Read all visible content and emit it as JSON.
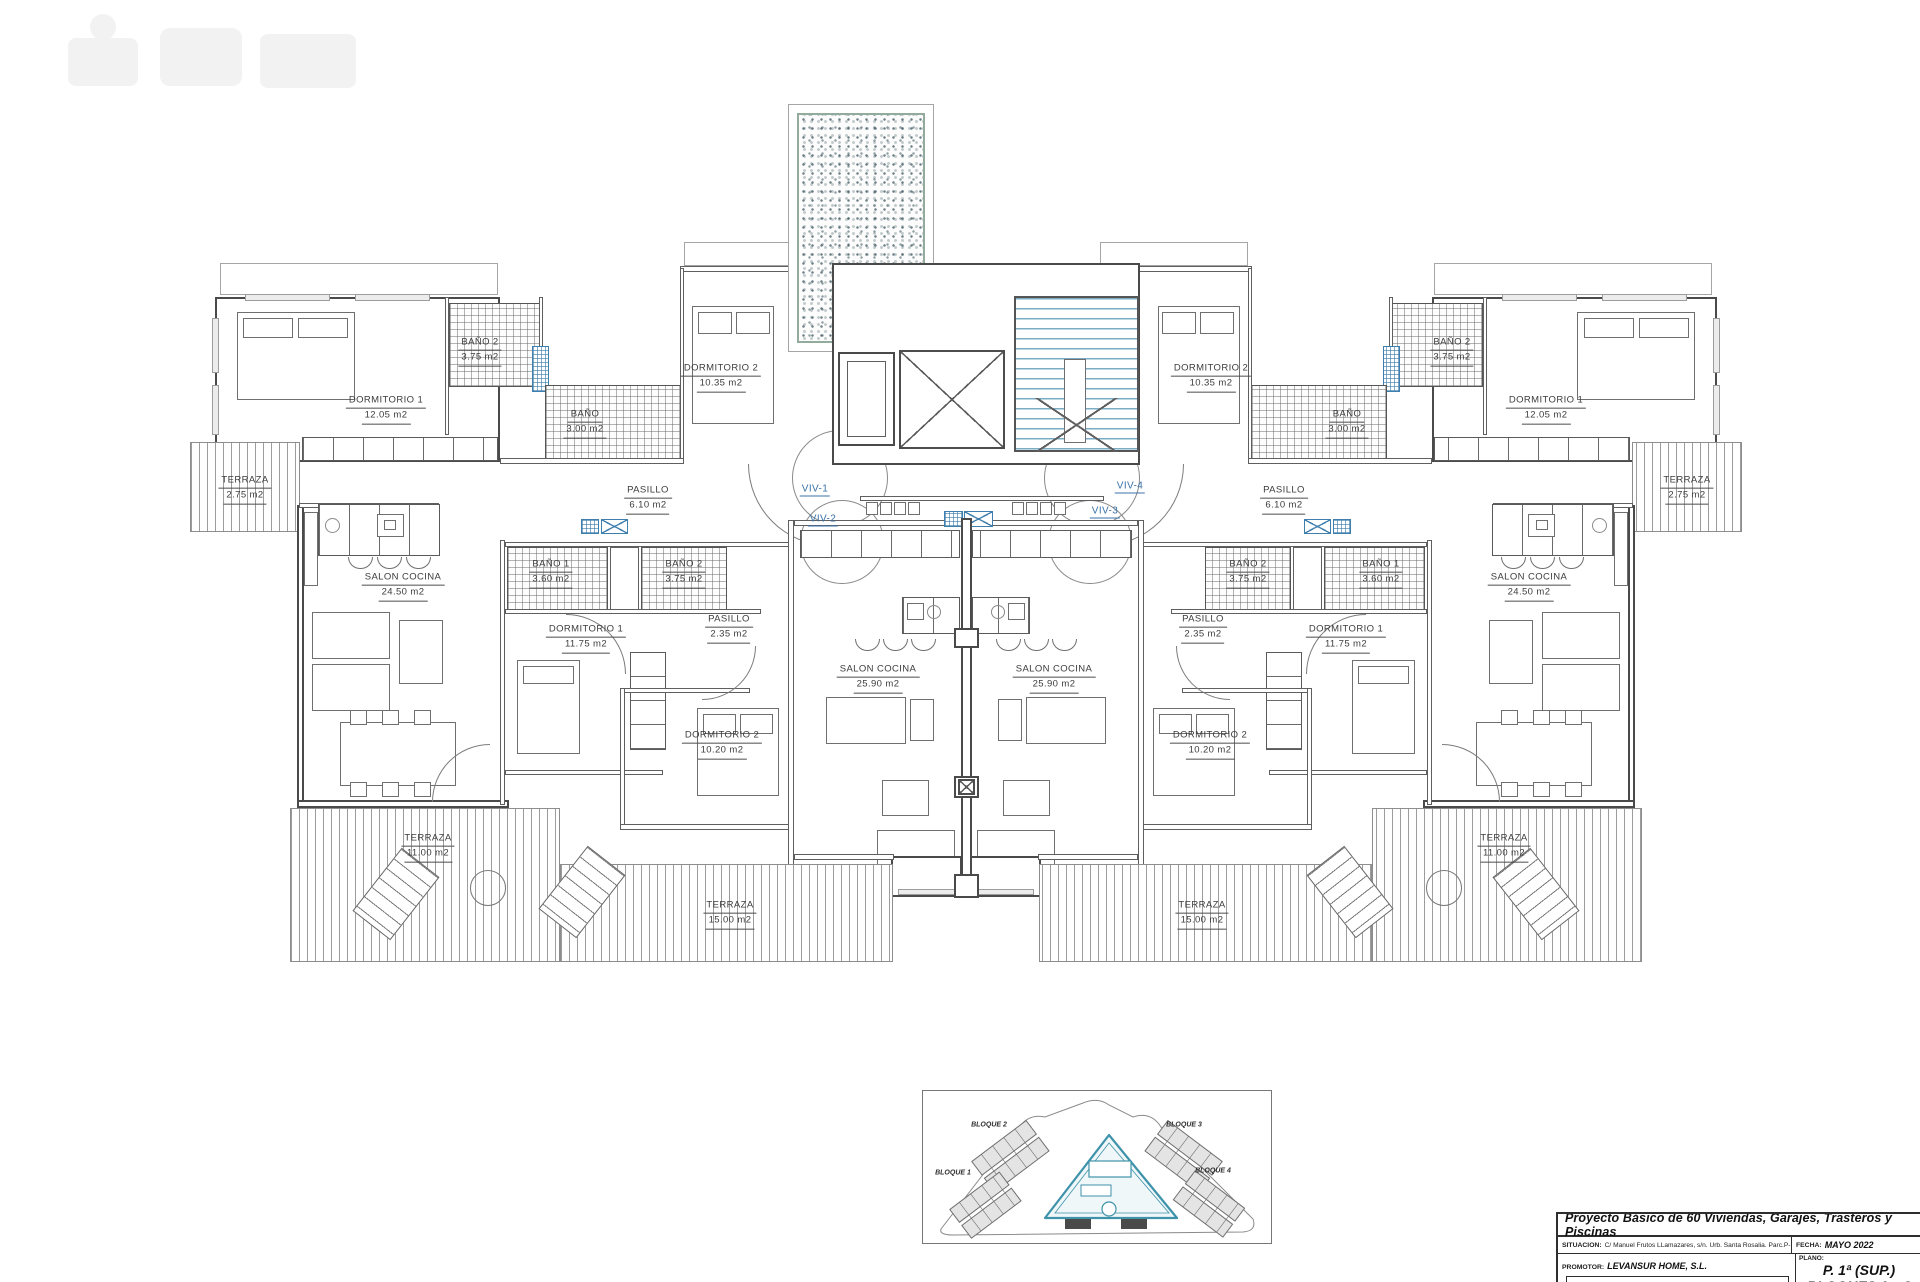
{
  "rooms": {
    "dorm1_top": {
      "name": "DORMITORIO 1",
      "area": "12.05 m2"
    },
    "bano2_top": {
      "name": "BAÑO 2",
      "area": "3.75 m2"
    },
    "bano_top": {
      "name": "BAÑO",
      "area": "3.00 m2"
    },
    "dorm2_top": {
      "name": "DORMITORIO 2",
      "area": "10.35 m2"
    },
    "terraza_top": {
      "name": "TERRAZA",
      "area": "2.75 m2"
    },
    "pasillo_top": {
      "name": "PASILLO",
      "area": "6.10 m2"
    },
    "salon_cocina_24": {
      "name": "SALON COCINA",
      "area": "24.50 m2"
    },
    "bano1_mid": {
      "name": "BAÑO 1",
      "area": "3.60 m2"
    },
    "bano2_mid": {
      "name": "BAÑO 2",
      "area": "3.75 m2"
    },
    "dorm1_mid": {
      "name": "DORMITORIO 1",
      "area": "11.75 m2"
    },
    "pasillo_mid": {
      "name": "PASILLO",
      "area": "2.35 m2"
    },
    "salon_cocina_25": {
      "name": "SALON COCINA",
      "area": "25.90 m2"
    },
    "dorm2_mid": {
      "name": "DORMITORIO 2",
      "area": "10.20 m2"
    },
    "terraza_11": {
      "name": "TERRAZA",
      "area": "11.00 m2"
    },
    "terraza_15": {
      "name": "TERRAZA",
      "area": "15.00 m2"
    }
  },
  "viv_labels": {
    "v1": "VIV-1",
    "v2": "VIV-2",
    "v3": "VIV-3",
    "v4": "VIV-4"
  },
  "site_plan": {
    "b1": "BLOQUE 1",
    "b2": "BLOQUE 2",
    "b3": "BLOQUE 3",
    "b4": "BLOQUE 4"
  },
  "title_block": {
    "project_title": "Proyecto Básico de 60 Viviendas, Garajes, Trasteros y Piscinas",
    "situacion_label": "SITUACION:",
    "situacion_value": "C/ Manuel Frutos LLamazares, s/n. Urb. Santa Rosalia. Parc.P-10",
    "promotor_label": "PROMOTOR:",
    "promotor_value": "LEVANSUR HOME, S.L.",
    "fecha_label": "FECHA:",
    "fecha_value": "MAYO 2022",
    "plano_label": "PLANO:",
    "plano_line1": "P. 1ª (SUP.)",
    "plano_line2": "BLOQUES 1 y 3"
  },
  "colors": {
    "accent_blue": "#3f7fae",
    "stair_teal": "#7aadc5",
    "pool_border": "#92ab9c",
    "line": "#4a4a4a"
  }
}
